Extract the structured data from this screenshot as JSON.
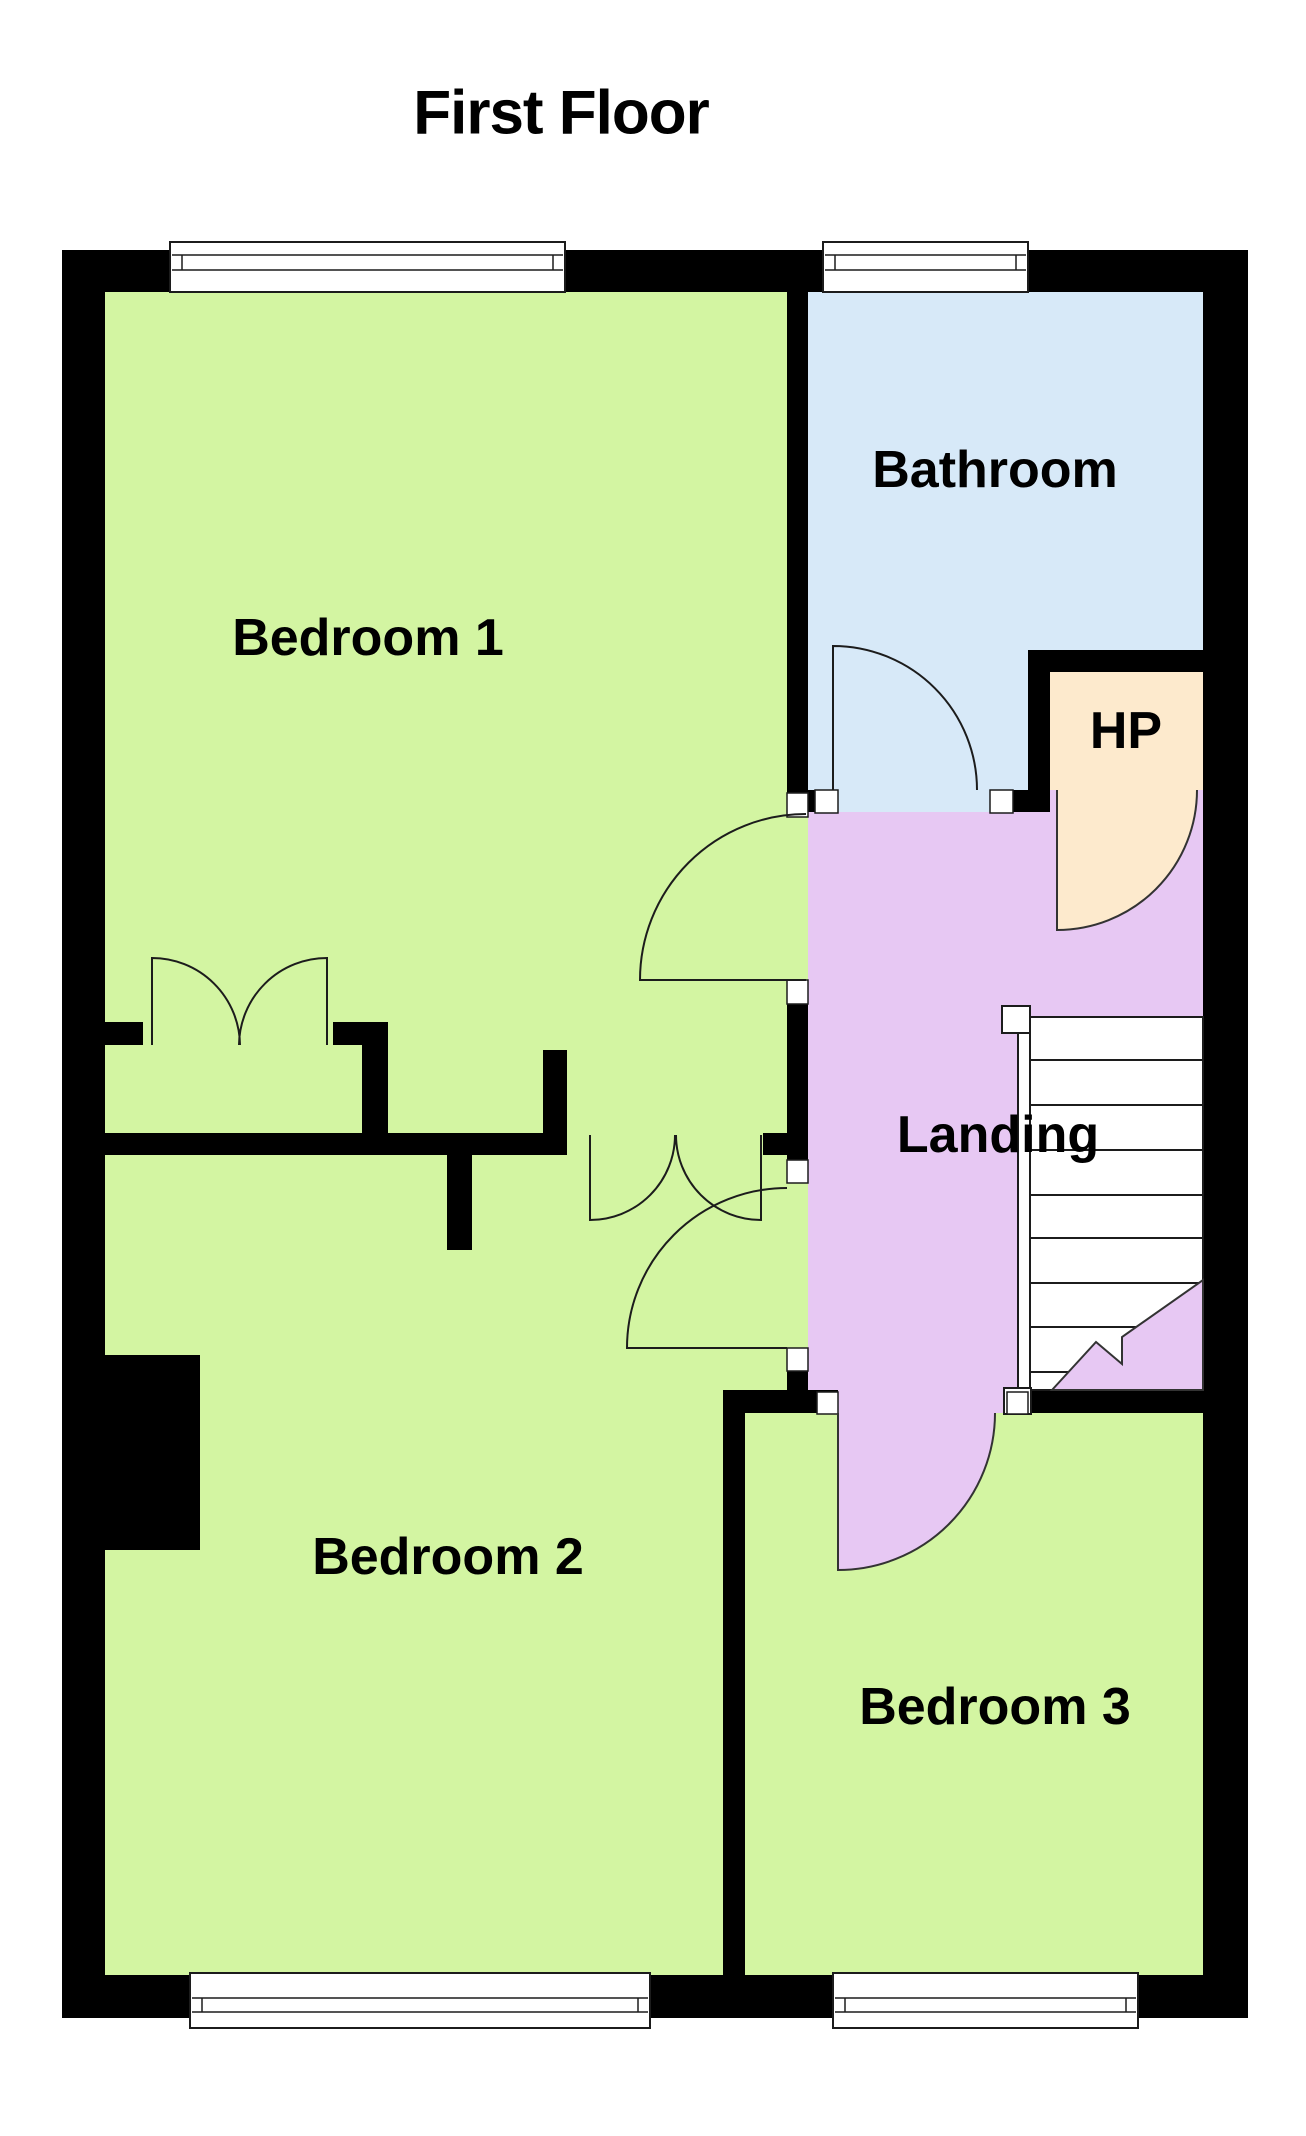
{
  "title": "First Floor",
  "rooms": {
    "bedroom1": {
      "label": "Bedroom 1"
    },
    "bathroom": {
      "label": "Bathroom"
    },
    "hot_press": {
      "label": "HP"
    },
    "landing": {
      "label": "Landing"
    },
    "bedroom2": {
      "label": "Bedroom 2"
    },
    "bedroom3": {
      "label": "Bedroom 3"
    }
  },
  "colors": {
    "bedroom_fill": "#d3f5a2",
    "bathroom_fill": "#d7e9f8",
    "landing_fill": "#e7c8f3",
    "hp_fill": "#fdeacd",
    "wall": "#000000",
    "window_fill": "#ffffff",
    "line": "#1c1c1c",
    "text": "#000000"
  }
}
